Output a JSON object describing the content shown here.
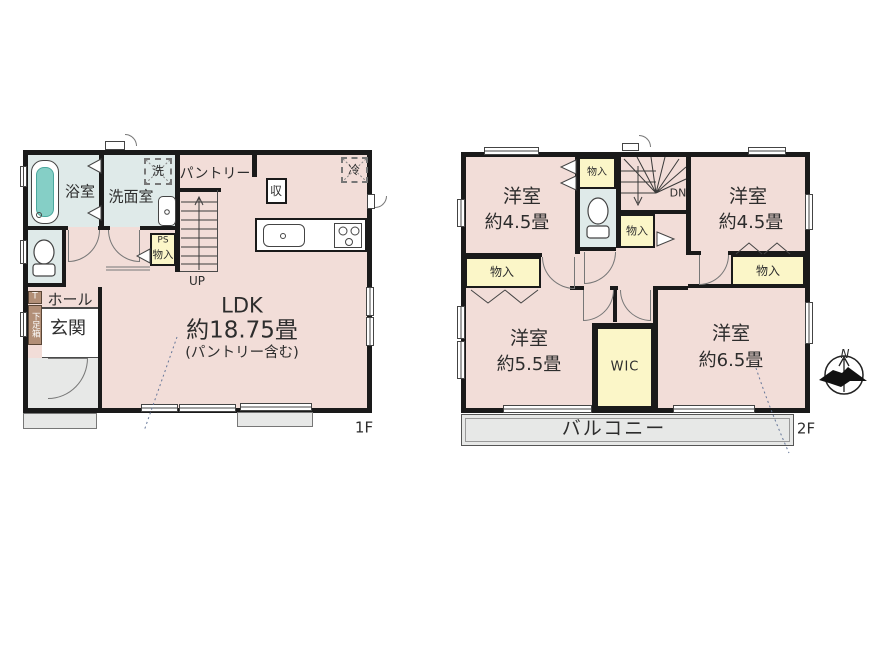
{
  "floor1": {
    "floor_label": "1F",
    "bath": "浴室",
    "washroom": "洗面室",
    "laundry": "洗",
    "pantry": "パントリー",
    "storage": "収",
    "fridge": "冷",
    "ps": "PS",
    "ps_closet": "物入",
    "stairs_up": "UP",
    "ldk": "LDK",
    "ldk_size": "約18.75畳",
    "ldk_note": "(パントリー含む)",
    "hall": "ホール",
    "entrance": "玄関",
    "shoe_t": "T",
    "shoe_cabinet": "下足箱"
  },
  "floor2": {
    "floor_label": "2F",
    "stairs_down": "DN",
    "balcony": "バルコニー",
    "wic": "WIC",
    "room_nw": {
      "name": "洋室",
      "size": "約4.5畳"
    },
    "room_ne": {
      "name": "洋室",
      "size": "約4.5畳"
    },
    "room_sw": {
      "name": "洋室",
      "size": "約5.5畳"
    },
    "room_se": {
      "name": "洋室",
      "size": "約6.5畳"
    },
    "closet_top": "物入",
    "closet_mid": "物入",
    "closet_west": "物入",
    "closet_east": "物入"
  },
  "compass": {
    "north": "N"
  },
  "colors": {
    "wall": "#1a1a1a",
    "room_pink": "#f2ddd8",
    "wet_blue": "#dfeae9",
    "closet_yellow": "#fbf6c8",
    "porch_gray": "#e7e8e7",
    "tub_teal": "#85cfc6",
    "shoe_brown": "#b28f77"
  }
}
